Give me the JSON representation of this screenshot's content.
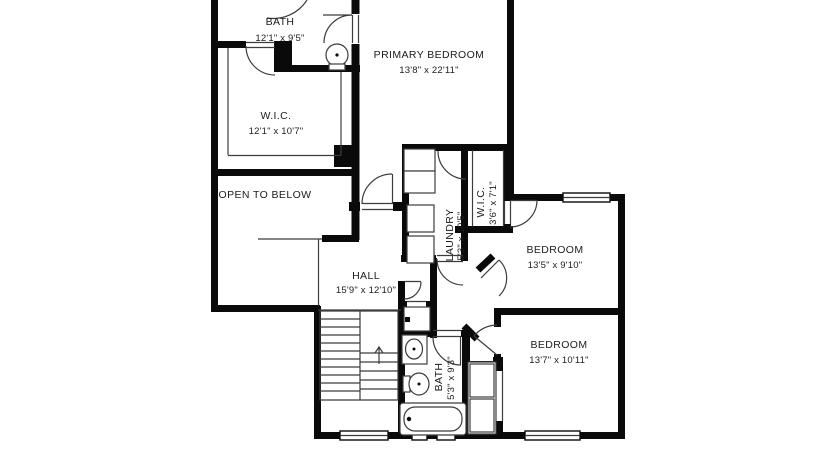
{
  "colors": {
    "wall": "#0a0a0a",
    "line": "#3c3c3c",
    "text": "#1c1c1c",
    "background": "#ffffff"
  },
  "rooms": [
    {
      "id": "bath-upper",
      "name": "BATH",
      "dims": "12'1\" x 9'5\""
    },
    {
      "id": "primary-bedroom",
      "name": "PRIMARY BEDROOM",
      "dims": "13'8\" x 22'11\""
    },
    {
      "id": "wic-primary",
      "name": "W.I.C.",
      "dims": "12'1\" x 10'7\""
    },
    {
      "id": "open-to-below",
      "name": "OPEN TO BELOW",
      "dims": ""
    },
    {
      "id": "laundry",
      "name": "LAUNDRY",
      "dims": "5'3\" x 10'5\""
    },
    {
      "id": "wic-bedroom",
      "name": "W.I.C.",
      "dims": "3'6\" x 7'1\""
    },
    {
      "id": "bedroom-ne",
      "name": "BEDROOM",
      "dims": "13'5\" x 9'10\""
    },
    {
      "id": "hall",
      "name": "HALL",
      "dims": "15'9\" x 12'10\""
    },
    {
      "id": "bedroom-se",
      "name": "BEDROOM",
      "dims": "13'7\" x 10'11\""
    },
    {
      "id": "bath-lower",
      "name": "BATH",
      "dims": "5'3\" x 9'3\""
    }
  ]
}
